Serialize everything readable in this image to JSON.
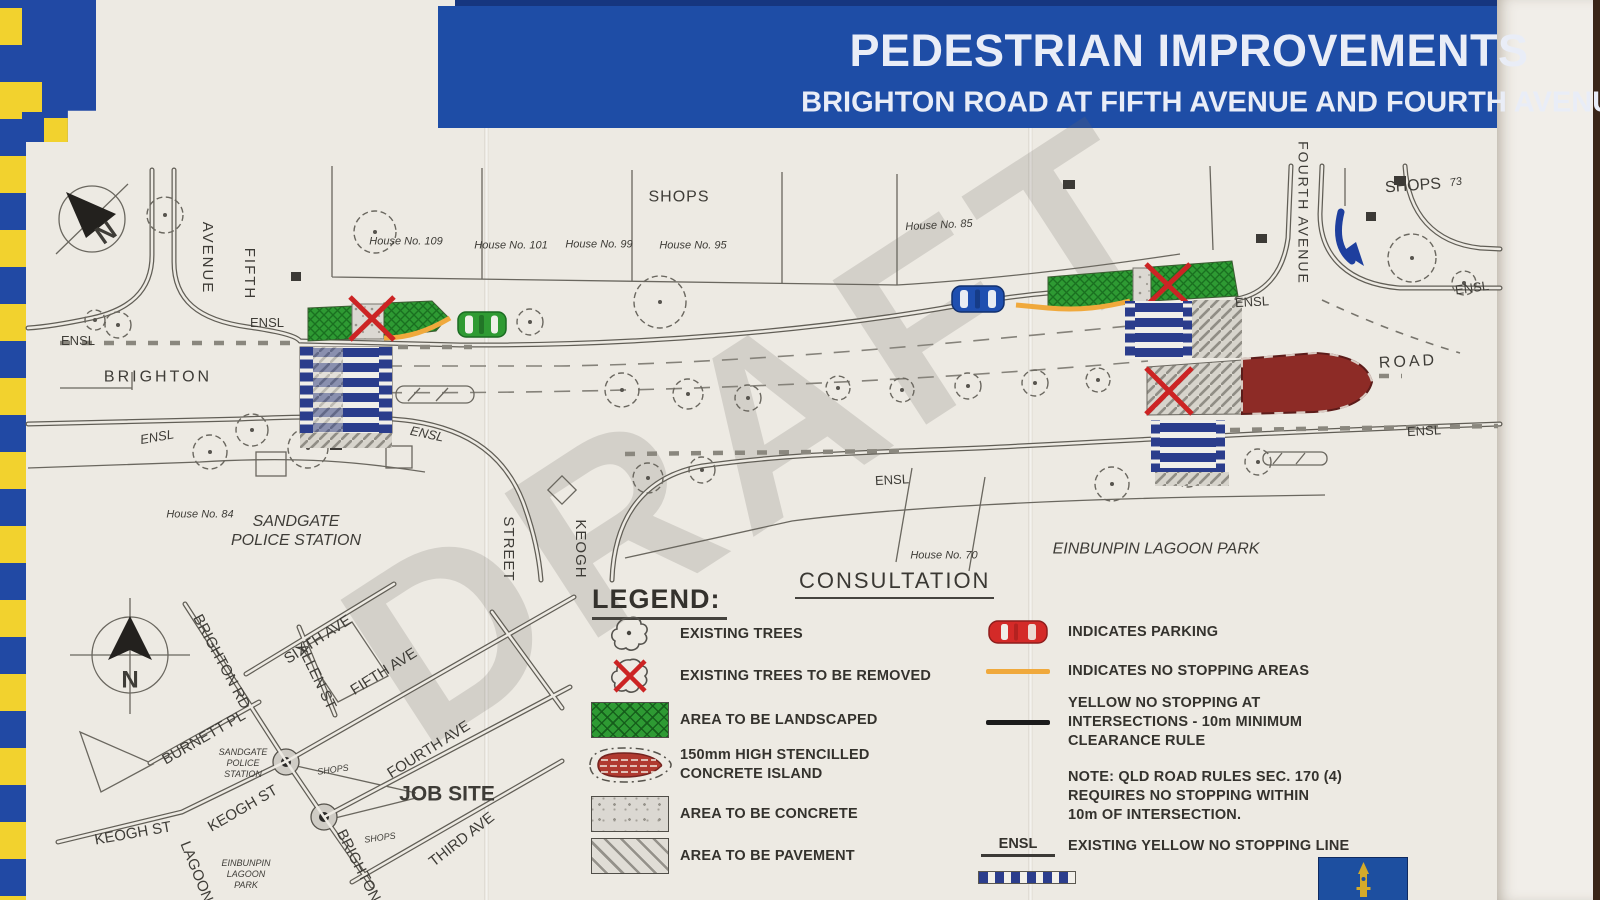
{
  "banner": {
    "title": "PEDESTRIAN IMPROVEMENTS",
    "subtitle": "BRIGHTON ROAD AT FIFTH AVENUE AND FOURTH AVENUE - SANDGATE"
  },
  "watermark": "DRAFT",
  "plan": {
    "labels": [
      {
        "t": "AVENUE",
        "x": 207,
        "y": 258,
        "r": 90,
        "s": 15,
        "ls": 2
      },
      {
        "t": "FIFTH",
        "x": 249,
        "y": 274,
        "r": 90,
        "s": 15,
        "ls": 2
      },
      {
        "t": "ENSL",
        "x": 78,
        "y": 341,
        "r": 0,
        "s": 13
      },
      {
        "t": "ENSL",
        "x": 267,
        "y": 323,
        "r": 0,
        "s": 13
      },
      {
        "t": "BRIGHTON",
        "x": 158,
        "y": 377,
        "r": 0,
        "s": 16,
        "ls": 3
      },
      {
        "t": "House No. 109",
        "x": 406,
        "y": 242,
        "r": 0,
        "s": 11,
        "i": true
      },
      {
        "t": "House No. 101",
        "x": 511,
        "y": 246,
        "r": 0,
        "s": 11,
        "i": true
      },
      {
        "t": "House No. 99",
        "x": 599,
        "y": 245,
        "r": 0,
        "s": 11,
        "i": true
      },
      {
        "t": "House No. 95",
        "x": 693,
        "y": 246,
        "r": 0,
        "s": 11,
        "i": true
      },
      {
        "t": "SHOPS",
        "x": 679,
        "y": 197,
        "r": 0,
        "s": 16,
        "ls": 1
      },
      {
        "t": "House No. 85",
        "x": 939,
        "y": 226,
        "r": -3,
        "s": 11,
        "i": true
      },
      {
        "t": "SHOPS",
        "x": 1413,
        "y": 186,
        "r": -4,
        "s": 16
      },
      {
        "t": "73",
        "x": 1456,
        "y": 183,
        "r": -10,
        "s": 11,
        "i": true
      },
      {
        "t": "FOURTH  AVENUE",
        "x": 1303,
        "y": 213,
        "r": 90,
        "s": 14,
        "ls": 2
      },
      {
        "t": "ENSL",
        "x": 1252,
        "y": 302,
        "r": -3,
        "s": 13
      },
      {
        "t": "ENSL",
        "x": 1472,
        "y": 288,
        "r": -8,
        "s": 13
      },
      {
        "t": "ROAD",
        "x": 1408,
        "y": 362,
        "r": -3,
        "s": 16,
        "ls": 3
      },
      {
        "t": "ENSL",
        "x": 1424,
        "y": 431,
        "r": -3,
        "s": 13
      },
      {
        "t": "ENSL",
        "x": 892,
        "y": 480,
        "r": -3,
        "s": 13
      },
      {
        "t": "ENSL",
        "x": 157,
        "y": 437,
        "r": -10,
        "s": 13,
        "i": true
      },
      {
        "t": "ENSL",
        "x": 427,
        "y": 434,
        "r": 12,
        "s": 13,
        "i": true
      },
      {
        "t": "House No. 84",
        "x": 200,
        "y": 515,
        "r": 0,
        "s": 11,
        "i": true
      },
      {
        "t": "SANDGATE\nPOLICE STATION",
        "x": 296,
        "y": 531,
        "r": 0,
        "s": 16,
        "i": true
      },
      {
        "t": "STREET",
        "x": 508,
        "y": 549,
        "r": 90,
        "s": 15,
        "ls": 1
      },
      {
        "t": "KEOGH",
        "x": 580,
        "y": 549,
        "r": 90,
        "s": 15,
        "ls": 1
      },
      {
        "t": "House No. 70",
        "x": 944,
        "y": 556,
        "r": 0,
        "s": 11,
        "i": true
      },
      {
        "t": "EINBUNPIN LAGOON PARK",
        "x": 1156,
        "y": 549,
        "r": 0,
        "s": 16,
        "i": true
      },
      {
        "t": "N",
        "x": 106,
        "y": 233,
        "r": -35,
        "s": 26,
        "b": true
      }
    ]
  },
  "locality_map": {
    "labels": [
      {
        "t": "BRIGHTON RD",
        "x": 221,
        "y": 662,
        "r": 62,
        "s": 15
      },
      {
        "t": "SIXTH AVE",
        "x": 318,
        "y": 640,
        "r": -33,
        "s": 15
      },
      {
        "t": "ALLEN ST",
        "x": 316,
        "y": 677,
        "r": 64,
        "s": 15
      },
      {
        "t": "FIFTH AVE",
        "x": 384,
        "y": 672,
        "r": -32,
        "s": 15
      },
      {
        "t": "BURNETT PL",
        "x": 204,
        "y": 738,
        "r": -30,
        "s": 15
      },
      {
        "t": "SANDGATE\nPOLICE\nSTATION",
        "x": 243,
        "y": 763,
        "r": 0,
        "s": 9,
        "i": true
      },
      {
        "t": "FOURTH AVE",
        "x": 429,
        "y": 750,
        "r": -32,
        "s": 15
      },
      {
        "t": "SHOPS",
        "x": 333,
        "y": 770,
        "r": -8,
        "s": 9,
        "i": true
      },
      {
        "t": "JOB SITE",
        "x": 447,
        "y": 794,
        "r": 0,
        "s": 21,
        "b": true
      },
      {
        "t": "KEOGH ST",
        "x": 243,
        "y": 809,
        "r": -30,
        "s": 15
      },
      {
        "t": "KEOGH ST",
        "x": 133,
        "y": 834,
        "r": -10,
        "s": 15
      },
      {
        "t": "THIRD AVE",
        "x": 462,
        "y": 840,
        "r": -38,
        "s": 15
      },
      {
        "t": "SHOPS",
        "x": 380,
        "y": 838,
        "r": -8,
        "s": 9,
        "i": true
      },
      {
        "t": "BRIGHTON",
        "x": 358,
        "y": 866,
        "r": 63,
        "s": 15
      },
      {
        "t": "LAGOON",
        "x": 196,
        "y": 872,
        "r": 68,
        "s": 15
      },
      {
        "t": "EINBUNPIN\nLAGOON\nPARK",
        "x": 246,
        "y": 874,
        "r": 0,
        "s": 9,
        "i": true
      },
      {
        "t": "N",
        "x": 130,
        "y": 681,
        "r": 0,
        "s": 24,
        "b": true
      }
    ]
  },
  "legend": {
    "heading": "LEGEND:",
    "items": [
      {
        "icon": "tree-icon",
        "label": "EXISTING TREES"
      },
      {
        "icon": "tree-removed-icon",
        "label": "EXISTING TREES TO BE REMOVED"
      },
      {
        "icon": "landscaped-swatch",
        "label": "AREA TO BE LANDSCAPED"
      },
      {
        "icon": "concrete-island-swatch",
        "label": "150mm HIGH STENCILLED\nCONCRETE ISLAND"
      },
      {
        "icon": "concrete-swatch",
        "label": "AREA TO BE CONCRETE"
      },
      {
        "icon": "pavement-swatch",
        "label": "AREA TO BE PAVEMENT"
      }
    ]
  },
  "consultation": {
    "heading": "CONSULTATION",
    "notes": [
      {
        "icon": "parking-car-icon",
        "label": "INDICATES PARKING"
      },
      {
        "icon": "orange-line-icon",
        "label": "INDICATES NO STOPPING AREAS"
      },
      {
        "icon": "black-line-icon",
        "label": "YELLOW NO STOPPING AT\nINTERSECTIONS - 10m MINIMUM\nCLEARANCE RULE"
      },
      {
        "icon": "none",
        "label": "NOTE: QLD ROAD RULES SEC. 170 (4)\nREQUIRES NO STOPPING WITHIN\n10m OF INTERSECTION."
      },
      {
        "icon": "ensl-line-symbol",
        "symbol_text": "ENSL",
        "label": "EXISTING YELLOW NO STOPPING LINE"
      }
    ]
  },
  "footer": {
    "logo_icon": "clock-tower-icon"
  },
  "colors": {
    "banner_blue": "#1e4da6",
    "checker_blue": "#2149a4",
    "checker_yellow": "#f2d22e",
    "landscape_green": "#2e9a33",
    "crossing_navy": "#2b3d8c",
    "island_red": "#8d2b26",
    "no_stopping_orange": "#f0a93c",
    "removal_red": "#cc2424",
    "paper": "#edeae3"
  }
}
